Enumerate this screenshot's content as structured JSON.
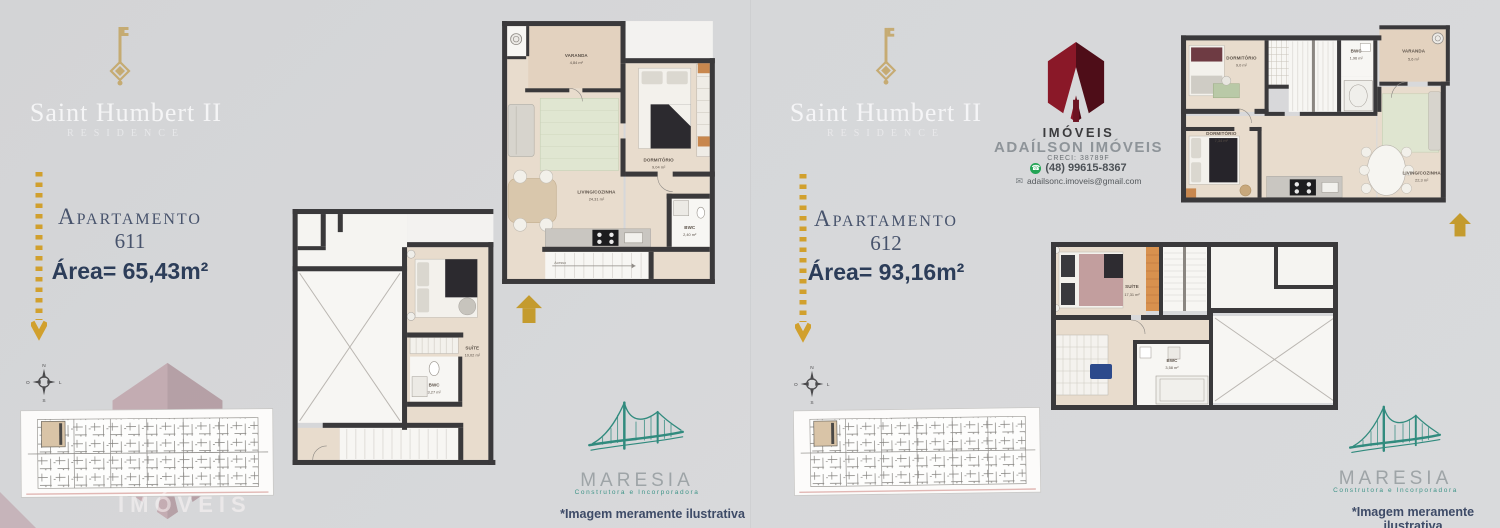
{
  "colors": {
    "background": "#d6d7d9",
    "accent_gold": "#d1a02d",
    "navy_text": "#2c3d59",
    "wall_dark": "#3a393b",
    "floor_beige": "#e8dccd",
    "maresia_teal": "#318b7e",
    "realtor_maroon": "#7d1626",
    "whatsapp_green": "#23a455"
  },
  "shared": {
    "brand_title": "Saint Humbert II",
    "brand_subtitle": "RESIDENCE",
    "apartment_label": "Apartamento",
    "disclaimer": "*Imagem meramente ilustrativa",
    "maresia_name": "MARESIA",
    "maresia_tagline": "Construtora e Incorporadora",
    "watermark_text": "IMÓVEIS",
    "compass": {
      "n": "N",
      "e": "L",
      "s": "S",
      "w": "O"
    }
  },
  "left": {
    "apartment_number": "611",
    "area": "Área= 65,43m²",
    "upper": {
      "varanda": "VARANDA",
      "varanda_area": "4,84 m²",
      "dormitorio": "DORMITÓRIO",
      "dormitorio_area": "9,04 m²",
      "living": "LIVING/COZINHA",
      "living_area": "24,31 m²",
      "bwc": "BWC",
      "bwc_area": "2,40 m²",
      "acesso": "Acesso"
    },
    "lower": {
      "suite": "SUÍTE",
      "suite_area": "10,02 m²",
      "bwc": "BWC",
      "bwc_area": "3,27 m²"
    }
  },
  "right": {
    "apartment_number": "612",
    "area": "Área= 93,16m²",
    "realtor": {
      "logo_caption": "IMÓVEIS",
      "name": "ADAÍLSON IMÓVEIS",
      "creci": "CRECI: 38789F",
      "phone": "(48) 99615-8367",
      "email": "adailsonc.imoveis@gmail.com"
    },
    "upper": {
      "dormitorio1": "DORMITÓRIO",
      "dormitorio1_area": "9,0 m²",
      "bwc": "BWC",
      "bwc_area": "1,96 m²",
      "varanda": "VARANDA",
      "varanda_area": "5,6 m²",
      "dormitorio2": "DORMITÓRIO",
      "dormitorio2_area": "7,34 m²",
      "living": "LIVING/COZINHA",
      "living_area": "22,3 m²"
    },
    "lower": {
      "suite": "SUÍTE",
      "suite_area": "17,31 m²",
      "bwc": "BWC",
      "bwc_area": "3,58 m²"
    }
  }
}
